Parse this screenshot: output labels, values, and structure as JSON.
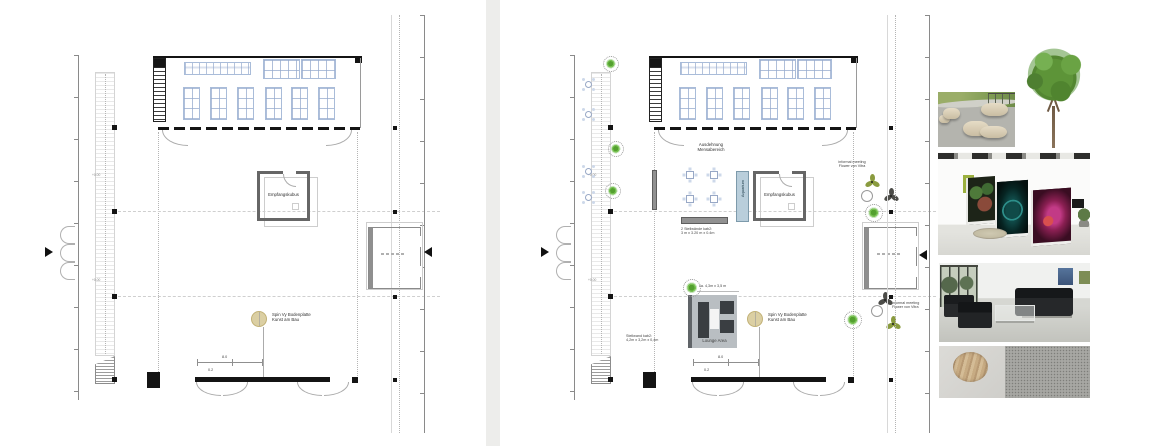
{
  "plan_left": {
    "reception": "Empfangskubus",
    "spin_line1": "Spin Vy Bodenplatte",
    "spin_line2": "Kunst am Bau",
    "level_mark": "+0.00",
    "dim_width": "8.0",
    "dim_small": "0.2"
  },
  "plan_right": {
    "mensa_line1": "Ausdehnung",
    "mensa_line2": "Mensabereich",
    "aquarium": "Aquarium",
    "reception": "Empfangskubus",
    "partition2_line1": "2 Stellwände kab2:",
    "partition2_line2": "3 m x 3.20 m x 0.4m",
    "informal_line1": "informal meeting",
    "informal_line2": "Flower von Vitra",
    "partition1_line1": "Stellwand kab2:",
    "partition1_line2": "4,2m x 3,2m x 0,4m",
    "lounge": "Lounge Area",
    "lounge_dim": "ca. 4,3m x 3,5 m",
    "spin_line1": "Spin Vy Bodenplatte",
    "spin_line2": "Kunst am Bau",
    "level_mark": "+0.00",
    "dim_width": "8.0",
    "dim_small": "0.2"
  },
  "photos": [
    {
      "name": "outdoor-benches"
    },
    {
      "name": "tree"
    },
    {
      "name": "gallery-exhibition-panels"
    },
    {
      "name": "lobby-black-sofas"
    },
    {
      "name": "material-samples"
    }
  ],
  "colors": {
    "furniture_blue": "#a9bcd9",
    "partition_gray": "#919191",
    "lounge_gray": "#b9bec2",
    "spin_tan": "#dbcfa3",
    "tree_green": "#53a02f",
    "flower_olive": "#8a9b3f",
    "flower_dark": "#4c4c48",
    "aquarium_blue": "#b9cedb",
    "divider_gray": "#ededeb"
  }
}
